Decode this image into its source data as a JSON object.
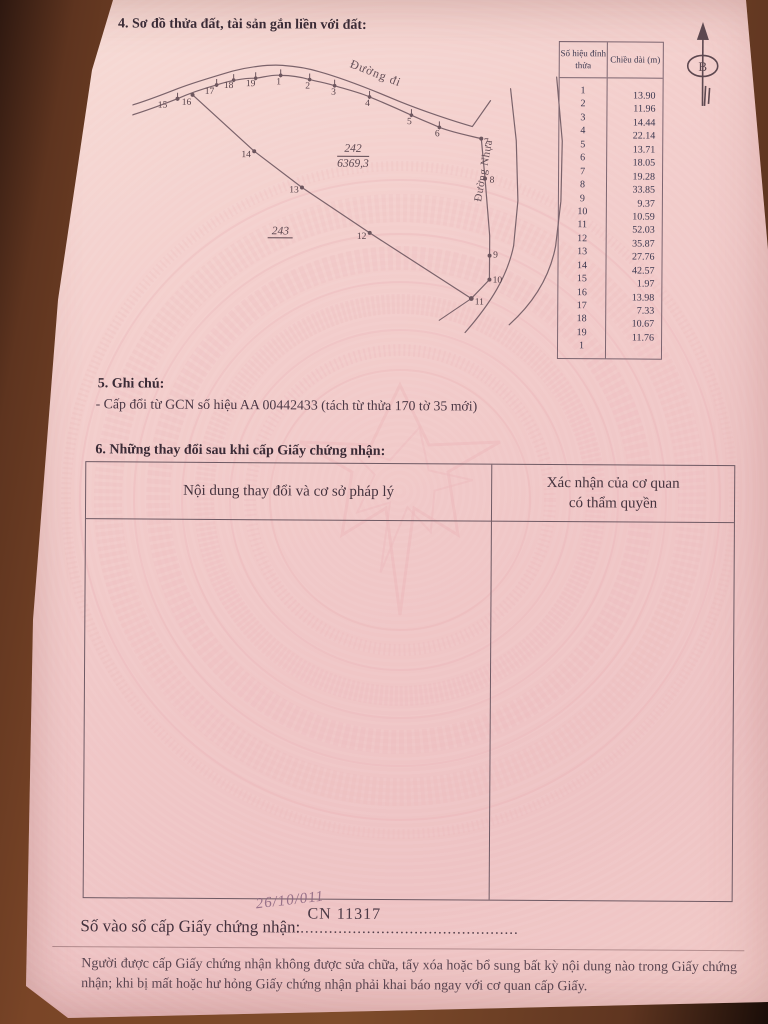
{
  "section4": {
    "title": "4. Sơ đồ thửa đất, tài sản gắn liền với đất:"
  },
  "diagram": {
    "parcel_number": "242",
    "parcel_area": "6369,3",
    "adjacent_parcel": "243",
    "road_top_label": "Đường đi",
    "road_right_label": "Đường Nhựa",
    "north_label": "B",
    "vertex_labels": [
      {
        "n": "15",
        "x": 30,
        "y": 57
      },
      {
        "n": "16",
        "x": 54,
        "y": 54
      },
      {
        "n": "17",
        "x": 77,
        "y": 43
      },
      {
        "n": "18",
        "x": 96,
        "y": 37
      },
      {
        "n": "19",
        "x": 118,
        "y": 35
      },
      {
        "n": "1",
        "x": 146,
        "y": 33
      },
      {
        "n": "2",
        "x": 175,
        "y": 37
      },
      {
        "n": "3",
        "x": 201,
        "y": 43
      },
      {
        "n": "4",
        "x": 235,
        "y": 54
      },
      {
        "n": "5",
        "x": 277,
        "y": 72
      },
      {
        "n": "6",
        "x": 305,
        "y": 84
      },
      {
        "n": "7",
        "x": 354,
        "y": 92
      },
      {
        "n": "8",
        "x": 360,
        "y": 130
      },
      {
        "n": "9",
        "x": 364,
        "y": 205
      },
      {
        "n": "10",
        "x": 366,
        "y": 230
      },
      {
        "n": "11",
        "x": 348,
        "y": 252
      },
      {
        "n": "12",
        "x": 230,
        "y": 187
      },
      {
        "n": "13",
        "x": 162,
        "y": 141
      },
      {
        "n": "14",
        "x": 114,
        "y": 106
      }
    ]
  },
  "measure_table": {
    "col1_header": "Số hiệu đỉnh thửa",
    "col2_header": "Chiều dài (m)",
    "vertices": [
      "1",
      "2",
      "3",
      "4",
      "5",
      "6",
      "7",
      "8",
      "9",
      "10",
      "11",
      "12",
      "13",
      "14",
      "15",
      "16",
      "17",
      "18",
      "19",
      "1"
    ],
    "lengths": [
      "13.90",
      "11.96",
      "14.44",
      "22.14",
      "13.71",
      "18.05",
      "19.28",
      "33.85",
      "9.37",
      "10.59",
      "52.03",
      "35.87",
      "27.76",
      "42.57",
      "1.97",
      "13.98",
      "7.33",
      "10.67",
      "11.76"
    ]
  },
  "section5": {
    "title": "5. Ghi chú:",
    "note": "- Cấp đổi từ GCN số hiệu AA 00442433 (tách từ thửa 170 tờ 35 mới)"
  },
  "section6": {
    "title": "6. Những thay đổi sau khi cấp Giấy chứng nhận:",
    "col1_header": "Nội dung thay đổi và cơ sở pháp lý",
    "col2_header_line1": "Xác nhận của cơ quan",
    "col2_header_line2": "có thẩm quyền"
  },
  "footer": {
    "register_label": "Số vào sổ cấp Giấy chứng nhận:",
    "register_dots": "..............................................",
    "register_number": "CN 11317",
    "handwritten_note": "26/10/011",
    "notice_line1": "Người được cấp Giấy chứng nhận không được sửa chữa, tẩy xóa hoặc bổ sung bất kỳ nội dung nào trong",
    "notice_line2": "Giấy chứng nhận; khi bị mất hoặc hư hỏng Giấy chứng nhận phải khai báo ngay với cơ quan cấp Giấy."
  },
  "colors": {
    "paper_pink": "#f2cbca",
    "emblem_pink": "#e9aeb3",
    "ink": "#4f3c49",
    "line": "#7b636b",
    "wood": "#7a4527"
  }
}
